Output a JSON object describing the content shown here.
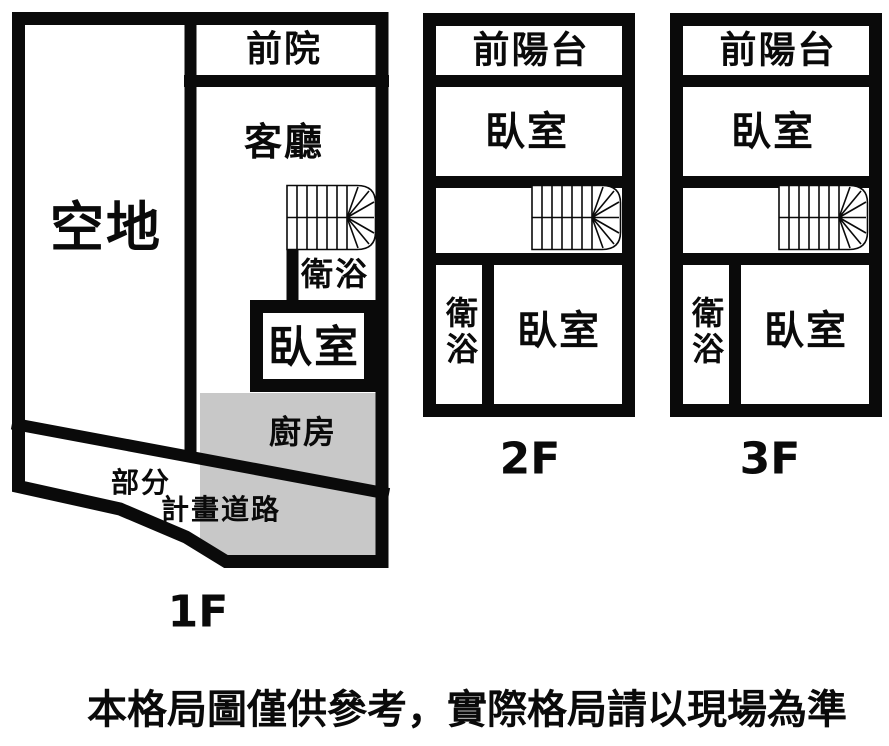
{
  "colors": {
    "wall": "#0a0a0a",
    "room_shading": "#c8c8c8",
    "background": "#ffffff",
    "text": "#0a0a0a"
  },
  "floor_1f": {
    "caption": "1F",
    "open_land": "空地",
    "front_yard": "前院",
    "living_room": "客廳",
    "bathroom": "衛浴",
    "bedroom": "臥室",
    "kitchen": "廚房",
    "road_line1": "部分",
    "road_line2": "計畫道路"
  },
  "floor_2f": {
    "caption": "2F",
    "front_balcony": "前陽台",
    "bedroom_front": "臥室",
    "bathroom": "衛浴",
    "bedroom_rear": "臥室"
  },
  "floor_3f": {
    "caption": "3F",
    "front_balcony": "前陽台",
    "bedroom_front": "臥室",
    "bathroom": "衛浴",
    "bedroom_rear": "臥室"
  },
  "disclaimer": "本格局圖僅供參考，實際格局請以現場為準"
}
